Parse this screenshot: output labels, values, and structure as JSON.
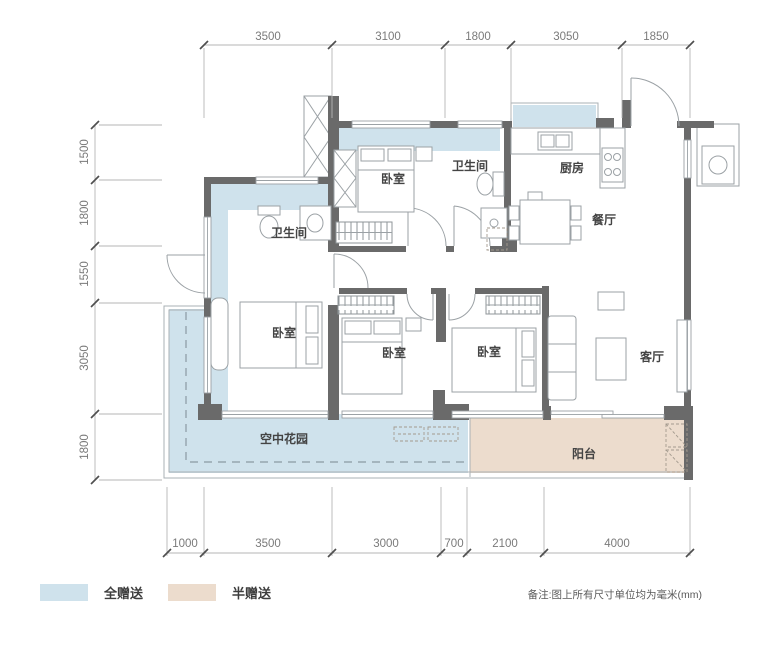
{
  "dimensions": {
    "top": [
      "3500",
      "3100",
      "1800",
      "3050",
      "1850"
    ],
    "left": [
      "1500",
      "1800",
      "1550",
      "3050",
      "1800"
    ],
    "bottom": [
      "1000",
      "3500",
      "3000",
      "700",
      "2100",
      "4000"
    ]
  },
  "rooms": {
    "bedroom_top": "卧室",
    "bathroom_top": "卫生间",
    "kitchen": "厨房",
    "dining": "餐厅",
    "bathroom_left": "卫生间",
    "bedroom_left": "卧室",
    "bedroom_mid": "卧室",
    "bedroom_right": "卧室",
    "living": "客厅",
    "sky_garden": "空中花园",
    "balcony": "阳台"
  },
  "legend": {
    "full_gift": {
      "label": "全赠送",
      "color": "#cfe2ec"
    },
    "half_gift": {
      "label": "半赠送",
      "color": "#ecdccd"
    }
  },
  "note": {
    "text": "备注:图上所有尺寸单位均为毫米(mm)"
  },
  "colors": {
    "wall": "#6a6a6a",
    "dim_line": "#b5b5b5",
    "dash_line": "#8b9aa3"
  }
}
